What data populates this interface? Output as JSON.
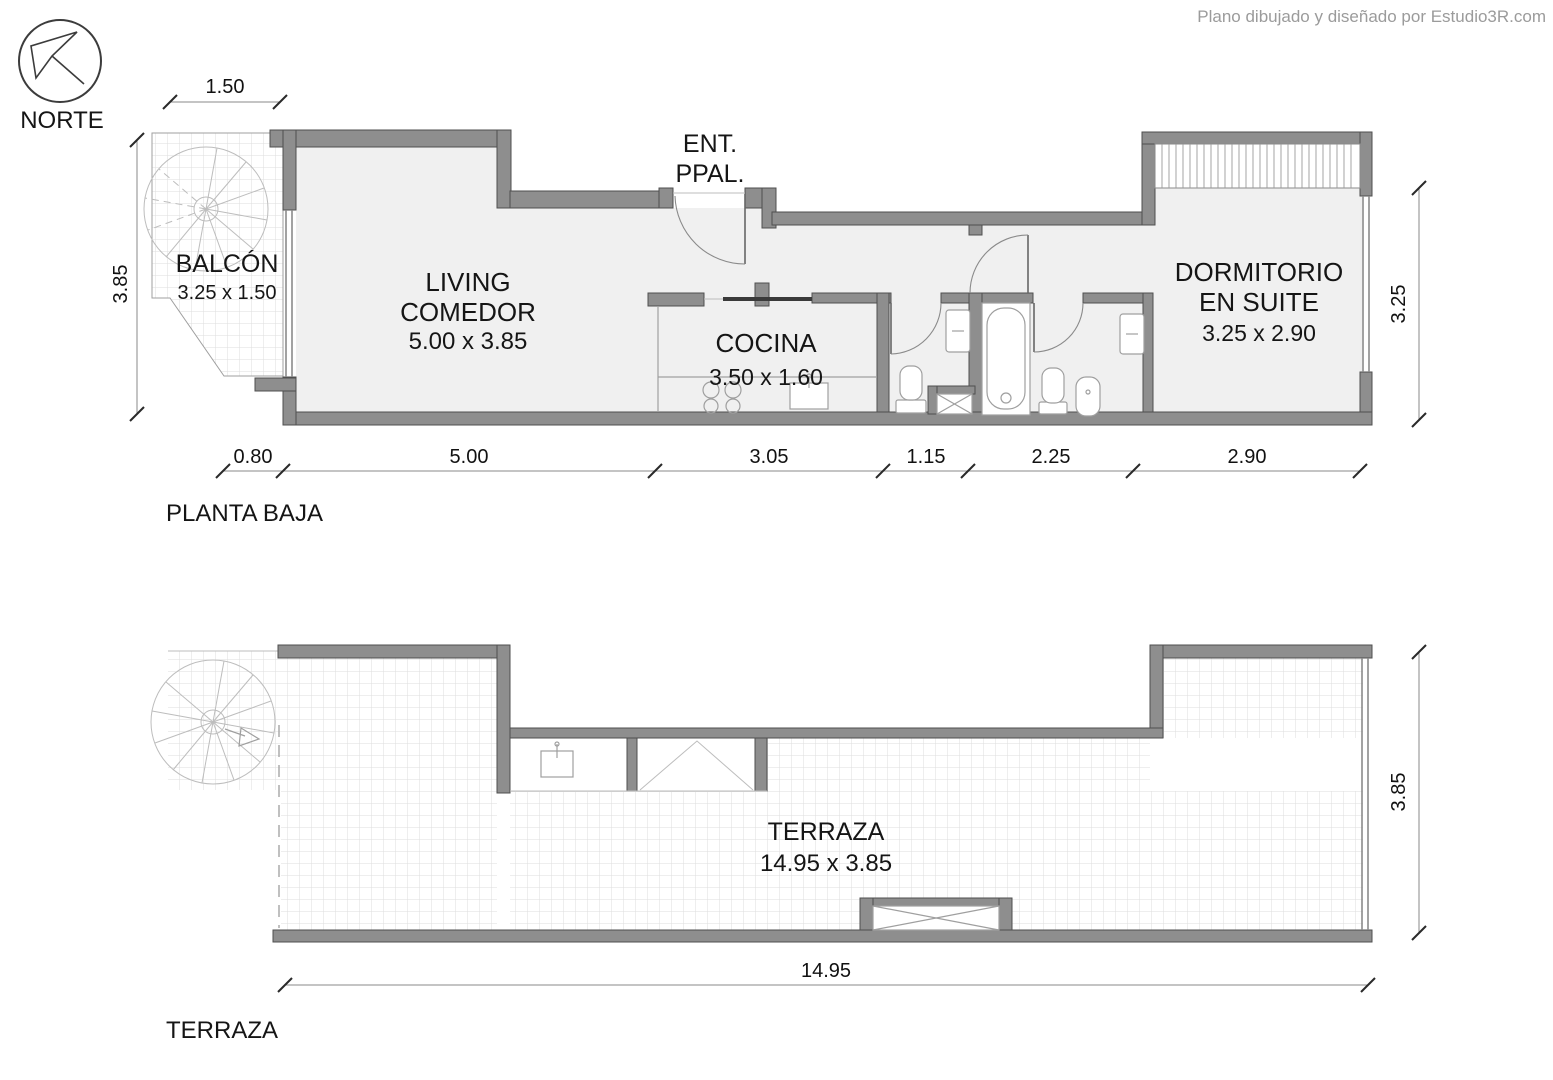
{
  "watermark": "Plano dibujado y diseñado por Estudio3R.com",
  "north_label": "NORTE",
  "planta_baja": {
    "title": "PLANTA BAJA",
    "balcon": {
      "name": "BALCÓN",
      "size": "3.25 x 1.50"
    },
    "living": {
      "line1": "LIVING",
      "line2": "COMEDOR",
      "size": "5.00 x 3.85"
    },
    "entrada": {
      "line1": "ENT.",
      "line2": "PPAL."
    },
    "cocina": {
      "name": "COCINA",
      "size": "3.50 x 1.60"
    },
    "dormitorio": {
      "line1": "DORMITORIO",
      "line2": "EN SUITE",
      "size": "3.25 x 2.90"
    },
    "dims": {
      "top": "1.50",
      "left": "3.85",
      "right": "3.25",
      "bottom": [
        "0.80",
        "5.00",
        "3.05",
        "1.15",
        "2.25",
        "2.90"
      ]
    }
  },
  "terraza": {
    "title": "TERRAZA",
    "label": {
      "name": "TERRAZA",
      "size": "14.95 x 3.85"
    },
    "dims": {
      "bottom": "14.95",
      "right": "3.85"
    }
  }
}
